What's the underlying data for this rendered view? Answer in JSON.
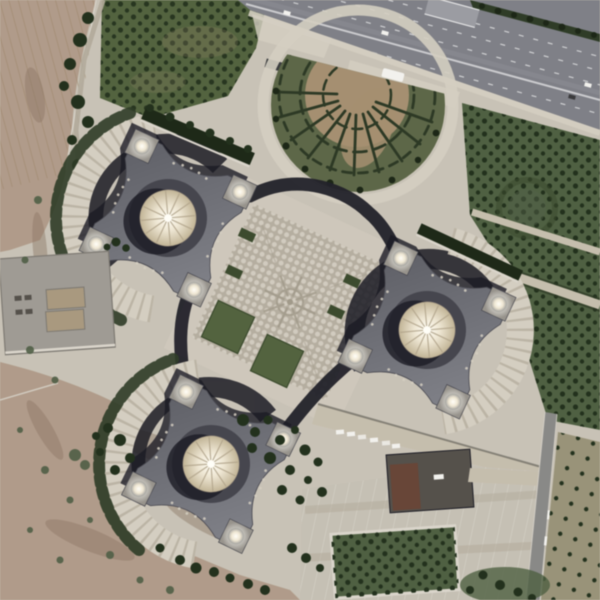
{
  "meta": {
    "title": "Aerial satellite view — monumental complex of three domed palace buildings beside a multi-lane highway",
    "view": "top-down orthographic satellite imagery",
    "size": "600x600"
  },
  "scene": {
    "counts": {
      "palace_buildings": 3,
      "corner_domes_per_building": 4,
      "central_domes": 3,
      "plaza_lawns": 2,
      "bus_shelters": 2
    },
    "features": [
      "highway-top",
      "hedge-median",
      "pedestrian-overpass",
      "bus",
      "cars",
      "ornamental-circle-garden-with-hedge-web",
      "tree-garden-east",
      "lawn-garden-north",
      "central-patterned-plaza",
      "palace-building-northwest",
      "palace-building-east",
      "palace-building-south",
      "arc-walkways",
      "desert-terrain-west",
      "service-structure-west",
      "service-building-south",
      "parking-lot",
      "parking-garden",
      "access-road-southeast",
      "orchard-southeast"
    ]
  },
  "palette": {
    "paving": "#c8c2b5",
    "paving_light": "#d4cec0",
    "paving_dim": "#b2aa99",
    "curb": "#dad5ca",
    "desert": "#b19b88",
    "desert_stain": "#8e7663",
    "furrow": "#9f8769",
    "lawn": "#52633d",
    "lawn_dark": "#3b4b2c",
    "tree": "#22311c",
    "shrub": "#4f5f45",
    "grass": "#4e6040",
    "garden_path": "#c6beac",
    "asphalt": "#7f8087",
    "asphalt_light": "#9b9ca2",
    "lane": "#e4e4e5",
    "hedge": "#2e3c26",
    "hedge_dot": "#1c2716",
    "shelter": "#3b3d3f",
    "veh_white": "#f2f1ed",
    "veh_dark": "#3a3a3c",
    "parterre_green": "#5d6746",
    "parterre_soil": "#a68f6f",
    "parterre_hedge": "#2c3924",
    "plaza": "#b6ae9f",
    "plaza_dot": "#d1cbbe",
    "plaza_line": "#a29a89",
    "ribbon": "#22222a",
    "shadow": "#1c1c25",
    "roof_dark": "#5e5f67",
    "roof_light": "#82838b",
    "roof_edge": "#494951",
    "tower": "#97938b",
    "dome_hi": "#fffef7",
    "dome_mid": "#efe6d1",
    "dome_lo": "#c3b595",
    "rib": "#b2a388",
    "recess": "#46464f",
    "dome_sm_edge": "#a2a29e",
    "canal": "#1d2917",
    "structure": "#9f9b93",
    "structure_in": "#aa997d",
    "structure_edge": "#7d7971",
    "service": "#55514b",
    "brick": "#6a4636",
    "parking": "#c5c0b3",
    "stall": "#ddd9ce",
    "road": "#898987",
    "orchard": "#999377",
    "edge_dark": "#59574e"
  }
}
